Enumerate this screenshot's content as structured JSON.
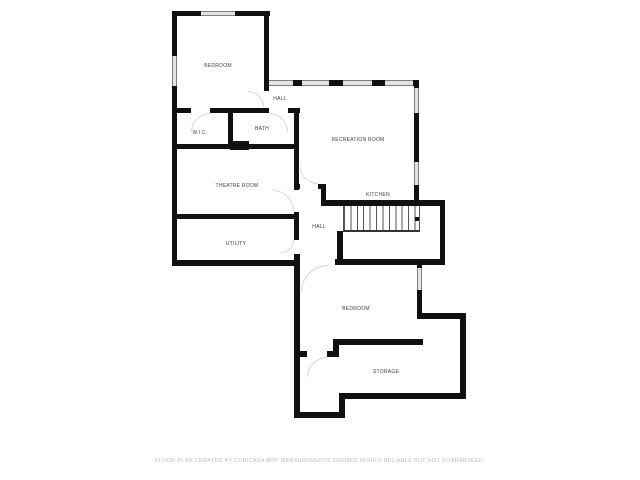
{
  "footer": {
    "text": "FLOOR PLAN CREATED BY CUBICASA APP. MEASUREMENTS DEEMED HIGHLY RELIABLE BUT NOT GUARANTEED."
  },
  "colors": {
    "wall": "#111111",
    "window_fill": "#e3e3e3",
    "window_edge": "#7f7f7f",
    "stair_line": "#555555",
    "door_arc": "#d6d6d6",
    "label_text": "#3f3f3f",
    "footer_text": "#bdbdbd",
    "background": "#ffffff"
  },
  "rooms": [
    {
      "id": "bedroom-upper",
      "label": "BEDROOM",
      "x": 218,
      "y": 66
    },
    {
      "id": "hall-upper",
      "label": "HALL",
      "x": 280,
      "y": 99
    },
    {
      "id": "wic",
      "label": "W.I.C.",
      "x": 200,
      "y": 133
    },
    {
      "id": "bath",
      "label": "BATH",
      "x": 262,
      "y": 129
    },
    {
      "id": "recreation-room",
      "label": "RECREATION ROOM",
      "x": 358,
      "y": 140
    },
    {
      "id": "theatre-room",
      "label": "THEATRE ROOM",
      "x": 237,
      "y": 186
    },
    {
      "id": "kitchen",
      "label": "KITCHEN",
      "x": 378,
      "y": 195
    },
    {
      "id": "hall-lower",
      "label": "HALL",
      "x": 319,
      "y": 227
    },
    {
      "id": "utility",
      "label": "UTILITY",
      "x": 236,
      "y": 244
    },
    {
      "id": "bedroom-lower",
      "label": "BEDROOM",
      "x": 356,
      "y": 309
    },
    {
      "id": "storage",
      "label": "STORAGE",
      "x": 386,
      "y": 372
    }
  ],
  "walls": [
    {
      "x": 172,
      "y": 11,
      "w": 98,
      "h": 5
    },
    {
      "x": 172,
      "y": 11,
      "w": 5,
      "h": 255
    },
    {
      "x": 264,
      "y": 11,
      "w": 5,
      "h": 80
    },
    {
      "x": 264,
      "y": 80,
      "w": 155,
      "h": 6
    },
    {
      "x": 414,
      "y": 80,
      "w": 5,
      "h": 126
    },
    {
      "x": 172,
      "y": 108,
      "w": 19,
      "h": 5
    },
    {
      "x": 210,
      "y": 108,
      "w": 59,
      "h": 5
    },
    {
      "x": 288,
      "y": 108,
      "w": 12,
      "h": 5
    },
    {
      "x": 228,
      "y": 111,
      "w": 5,
      "h": 33
    },
    {
      "x": 294,
      "y": 108,
      "w": 5,
      "h": 82
    },
    {
      "x": 172,
      "y": 144,
      "w": 127,
      "h": 5
    },
    {
      "x": 294,
      "y": 184,
      "w": 6,
      "h": 5
    },
    {
      "x": 318,
      "y": 184,
      "w": 8,
      "h": 5
    },
    {
      "x": 321,
      "y": 184,
      "w": 5,
      "h": 22
    },
    {
      "x": 321,
      "y": 200,
      "w": 124,
      "h": 6
    },
    {
      "x": 172,
      "y": 214,
      "w": 127,
      "h": 5
    },
    {
      "x": 294,
      "y": 212,
      "w": 5,
      "h": 28
    },
    {
      "x": 294,
      "y": 254,
      "w": 6,
      "h": 164
    },
    {
      "x": 172,
      "y": 260,
      "w": 128,
      "h": 6
    },
    {
      "x": 335,
      "y": 259,
      "w": 110,
      "h": 6
    },
    {
      "x": 337,
      "y": 231,
      "w": 6,
      "h": 34
    },
    {
      "x": 440,
      "y": 200,
      "w": 5,
      "h": 64
    },
    {
      "x": 417,
      "y": 259,
      "w": 5,
      "h": 60
    },
    {
      "x": 338,
      "y": 339,
      "w": 85,
      "h": 6
    },
    {
      "x": 333,
      "y": 339,
      "w": 6,
      "h": 18
    },
    {
      "x": 300,
      "y": 351,
      "w": 7,
      "h": 6
    },
    {
      "x": 327,
      "y": 351,
      "w": 12,
      "h": 6
    },
    {
      "x": 417,
      "y": 313,
      "w": 49,
      "h": 6
    },
    {
      "x": 460,
      "y": 313,
      "w": 6,
      "h": 86
    },
    {
      "x": 340,
      "y": 393,
      "w": 126,
      "h": 6
    },
    {
      "x": 339,
      "y": 393,
      "w": 6,
      "h": 25
    },
    {
      "x": 294,
      "y": 412,
      "w": 51,
      "h": 6
    }
  ],
  "door_blocks": [
    {
      "x": 230,
      "y": 141,
      "w": 19,
      "h": 9
    }
  ],
  "windows": [
    {
      "x": 201,
      "y": 11,
      "w": 34,
      "h": 5,
      "orient": "h"
    },
    {
      "x": 172,
      "y": 56,
      "w": 5,
      "h": 30,
      "orient": "v"
    },
    {
      "x": 269,
      "y": 80,
      "w": 24,
      "h": 6,
      "orient": "h"
    },
    {
      "x": 302,
      "y": 80,
      "w": 27,
      "h": 6,
      "orient": "h"
    },
    {
      "x": 343,
      "y": 80,
      "w": 29,
      "h": 6,
      "orient": "h"
    },
    {
      "x": 385,
      "y": 80,
      "w": 28,
      "h": 6,
      "orient": "h"
    },
    {
      "x": 414,
      "y": 88,
      "w": 5,
      "h": 25,
      "orient": "v"
    },
    {
      "x": 414,
      "y": 162,
      "w": 5,
      "h": 23,
      "orient": "v"
    },
    {
      "x": 417,
      "y": 268,
      "w": 5,
      "h": 22,
      "orient": "v"
    }
  ],
  "doors": [
    {
      "x": 248,
      "y": 91,
      "w": 16,
      "h": 16,
      "corner": "tr"
    },
    {
      "x": 191,
      "y": 113,
      "w": 19,
      "h": 19,
      "corner": "tl"
    },
    {
      "x": 269,
      "y": 113,
      "w": 19,
      "h": 19,
      "corner": "tr"
    },
    {
      "x": 273,
      "y": 190,
      "w": 21,
      "h": 21,
      "corner": "tr"
    },
    {
      "x": 281,
      "y": 240,
      "w": 13,
      "h": 13,
      "corner": "br"
    },
    {
      "x": 300,
      "y": 167,
      "w": 18,
      "h": 17,
      "corner": "bl"
    },
    {
      "x": 301,
      "y": 265,
      "w": 27,
      "h": 27,
      "corner": "tl"
    },
    {
      "x": 307,
      "y": 357,
      "w": 20,
      "h": 20,
      "corner": "tl"
    }
  ],
  "stairs": {
    "x": 343,
    "y": 206,
    "w": 77,
    "h": 26,
    "treads": 12,
    "marker": {
      "x": 415,
      "y": 217,
      "w": 4,
      "h": 4
    }
  }
}
